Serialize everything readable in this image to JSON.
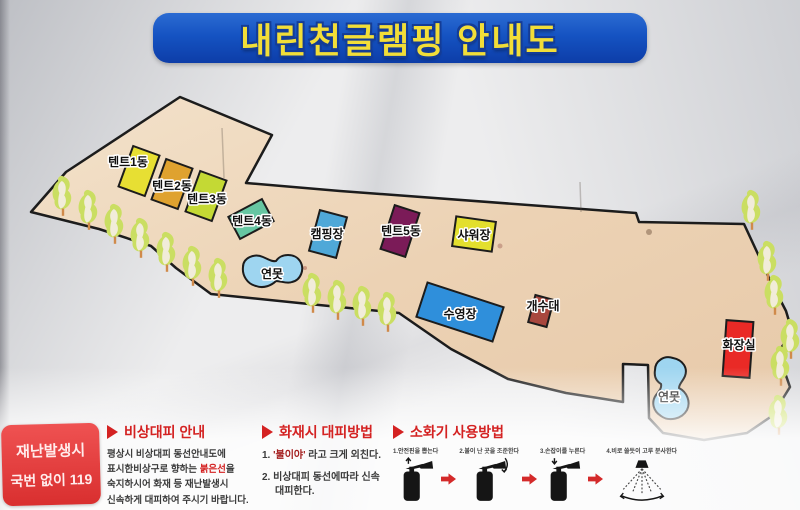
{
  "title": "내린천글램핑 안내도",
  "colors": {
    "banner_blue": "#1553c2",
    "title_yellow": "#f2de38",
    "map_tan": "#ecd2b4",
    "header_red": "#d42222",
    "emergency_red": "#e23a3a",
    "tree_green": "#cade62",
    "pond_blue": "#9ed5f0"
  },
  "map": {
    "buildings": [
      {
        "id": "tent1",
        "label": "텐트1동",
        "color": "#e7df33"
      },
      {
        "id": "tent2",
        "label": "텐트2동",
        "color": "#dfa22f"
      },
      {
        "id": "tent3",
        "label": "텐트3동",
        "color": "#c4d934"
      },
      {
        "id": "tent4",
        "label": "텐트4동",
        "color": "#66c6a2"
      },
      {
        "id": "campsite",
        "label": "캠핑장",
        "color": "#4fa8d8"
      },
      {
        "id": "tent5",
        "label": "텐트5동",
        "color": "#7b1b58"
      },
      {
        "id": "shower",
        "label": "샤워장",
        "color": "#e3df2e"
      },
      {
        "id": "pool",
        "label": "수영장",
        "color": "#2f8fdb"
      },
      {
        "id": "sink",
        "label": "개수대",
        "color": "#a8473e"
      },
      {
        "id": "toilet",
        "label": "화장실",
        "color": "#e92a26"
      }
    ],
    "ponds": [
      {
        "id": "pond-left",
        "label": "연못"
      },
      {
        "id": "pond-right",
        "label": "연못"
      }
    ]
  },
  "emergency": {
    "line1": "재난발생시",
    "line2": "국번 없이 119"
  },
  "sections": {
    "evacuation": {
      "title": "비상대피 안내",
      "line1": "평상시 비상대피 동선안내도에",
      "line2_pre": "표시한비상구로 향하는 ",
      "line2_red": "붉은선",
      "line2_post": "을",
      "line3": "숙지하시어 화재 등 재난발생시",
      "line4": "신속하게 대피하여 주시기 바랍니다."
    },
    "fire": {
      "title": "화재시 대피방법",
      "item1_pre": "1. ",
      "item1_red": "'불이야'",
      "item1_post": " 라고 크게 외친다.",
      "item2_line1": "2. 비상대피 동선에따라 신속",
      "item2_line2": "대피한다."
    },
    "extinguisher": {
      "title": "소화기 사용방법",
      "steps": [
        {
          "label": "1.안전핀을 뽑는다"
        },
        {
          "label": "2.불이 난 곳을 조준한다"
        },
        {
          "label": "3.손잡이를 누른다"
        },
        {
          "label": "4.비로 쓸듯이 고루 분사한다"
        }
      ]
    }
  }
}
